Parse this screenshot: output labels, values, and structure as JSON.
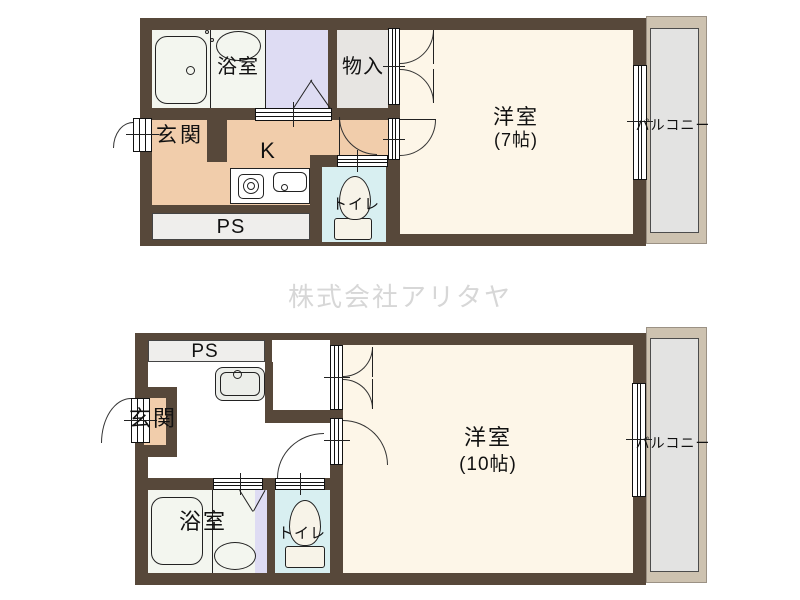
{
  "watermark": {
    "text": "株式会社アリタヤ"
  },
  "plan_top": {
    "labels": {
      "bath": "浴室",
      "storage": "物入",
      "entry": "玄関",
      "kitchen": "K",
      "toilet": "トイレ",
      "ps": "PS",
      "main_room": "洋室",
      "main_size": "(7帖)",
      "balcony": "バルコニー"
    }
  },
  "plan_bottom": {
    "labels": {
      "ps": "PS",
      "entry": "玄関",
      "bath": "浴室",
      "toilet": "トイレ",
      "main_room": "洋室",
      "main_size": "(10帖)",
      "balcony": "バルコニー"
    }
  },
  "colors": {
    "wall": "#57483a",
    "room_cream": "#fdf6e8",
    "peach": "#f1cdab",
    "storage_gray": "#e7e5e2",
    "ps_gray": "#efeeec",
    "toilet_cyan": "#d8eff1",
    "lavender": "#dedcf3",
    "bath_floor": "#f3f6ef",
    "hall_white": "#ffffff",
    "balcony_frame": "#cdc2b0",
    "balcony_floor": "#e3e3e2",
    "watermark": "#d7d7d7"
  }
}
